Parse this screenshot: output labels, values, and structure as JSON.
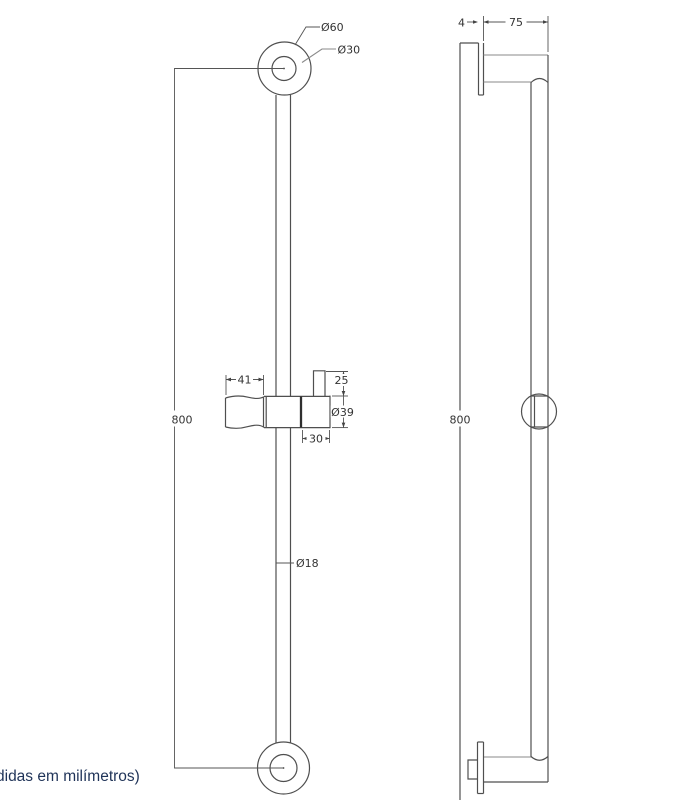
{
  "drawing": {
    "kind": "technical drawing - shower slide bar, two orthographic views",
    "units_note": "didas em milímetros)",
    "note_color": "#1f3358",
    "line_color": "#4f4f4f",
    "light_line_color": "#8a8a8a",
    "dim_text_color": "#333333",
    "background_color": "#ffffff"
  },
  "front_view": {
    "name": "front view",
    "labels": {
      "top_flange_outer_diameter": "Ø60",
      "top_flange_inner_diameter": "Ø30",
      "bar_height": "800",
      "holder_handle_length": "41",
      "holder_socket_height": "25",
      "slider_ring_diameter": "Ø39",
      "slider_ring_width": "30",
      "bar_tube_diameter": "Ø18"
    }
  },
  "side_view": {
    "name": "side view",
    "labels": {
      "wall_flange_thickness": "4",
      "wall_projection": "75",
      "bar_height": "800"
    }
  }
}
